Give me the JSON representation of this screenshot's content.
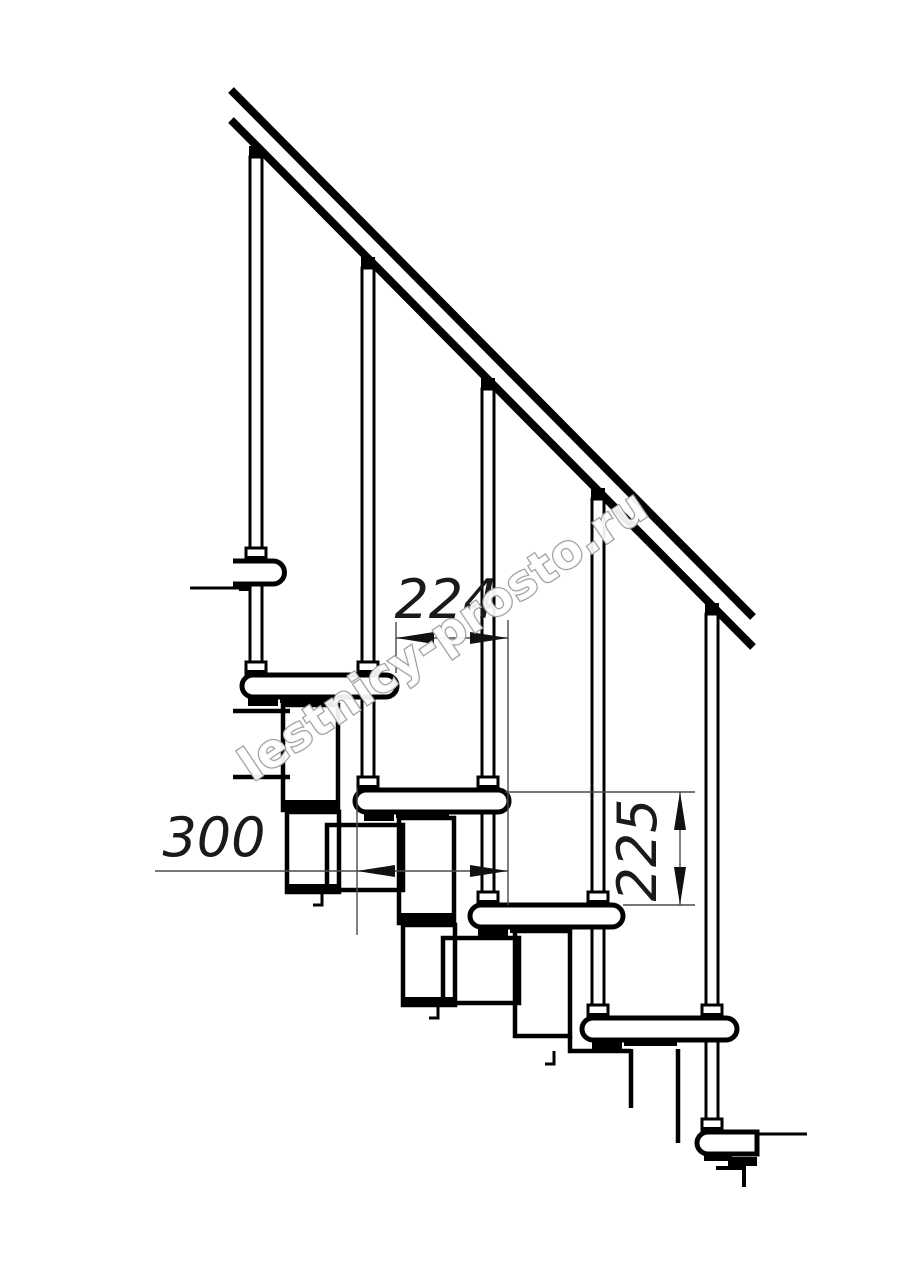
{
  "page": {
    "background": "#ffffff",
    "description": "Technical side-view drawing of a modular staircase with handrail, balusters, steps and dimension callouts"
  },
  "drawing": {
    "watermark": {
      "text": "lestnicy-prosto.ru",
      "outline_color": "#9f9f9f",
      "fill_color": "#ffffff"
    },
    "dimensions": [
      {
        "id": "step-run",
        "label": "224"
      },
      {
        "id": "step-length",
        "label": "300"
      },
      {
        "id": "step-rise",
        "label": "225"
      }
    ],
    "counts": {
      "steps_visible": "6",
      "balusters": "5"
    },
    "colors": {
      "line": "#000000",
      "dim_line": "#4a4a4a",
      "text": "#1a1a1a",
      "fill": "#ffffff"
    }
  }
}
